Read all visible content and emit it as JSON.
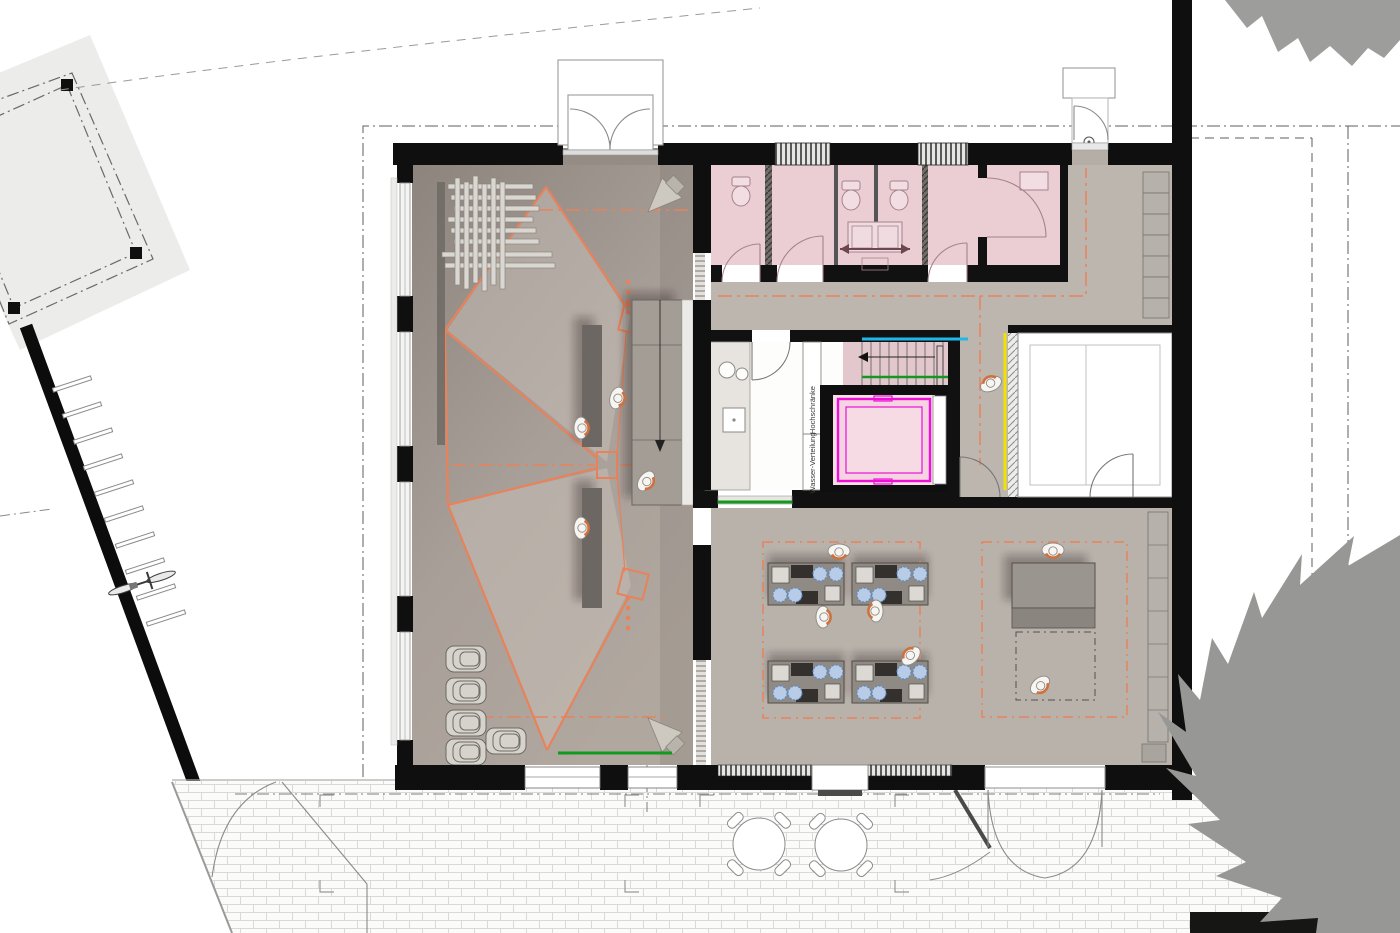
{
  "plan": {
    "type": "architectural-floor-plan-ground-floor",
    "labels": {
      "tall_cabinets": "Hochschränke",
      "water_distribution": "Wasser-Verteilung"
    },
    "colors": {
      "wall_black": "#111111",
      "projection_orange": "#e8825a",
      "elevator_magenta": "#ee10d8",
      "stair_cyan": "#1fb9e9",
      "safety_green": "#12991f",
      "marker_yellow": "#f0e203",
      "wc_pink": "#ebced3",
      "hob_blue": "#5b8ac6",
      "hall_floor_gray": "#a89f98",
      "corridor_gray": "#bcb6af",
      "tree_gray": "#9a9a9a"
    },
    "icons": {
      "toilet-icon": "ellipse bowl with tank",
      "washbasin-icon": "double basin with arrows",
      "person-icon": "top-view figure with orange shoulders",
      "speaker-icon": "cone wedge in corner",
      "bicycle-icon": "top-view bicycle at racks",
      "chair-stack-icon": "nested stacked chairs",
      "cooking-station-icon": "workbench with hobs, sinks and blue burners",
      "terrace-table-icon": "round table with four chairs",
      "tree-icon": "spiky canopy outline",
      "door-icon": "quarter-circle swing arc",
      "elevator-icon": "magenta framed cab",
      "stair-icon": "treads with down arrow"
    }
  }
}
